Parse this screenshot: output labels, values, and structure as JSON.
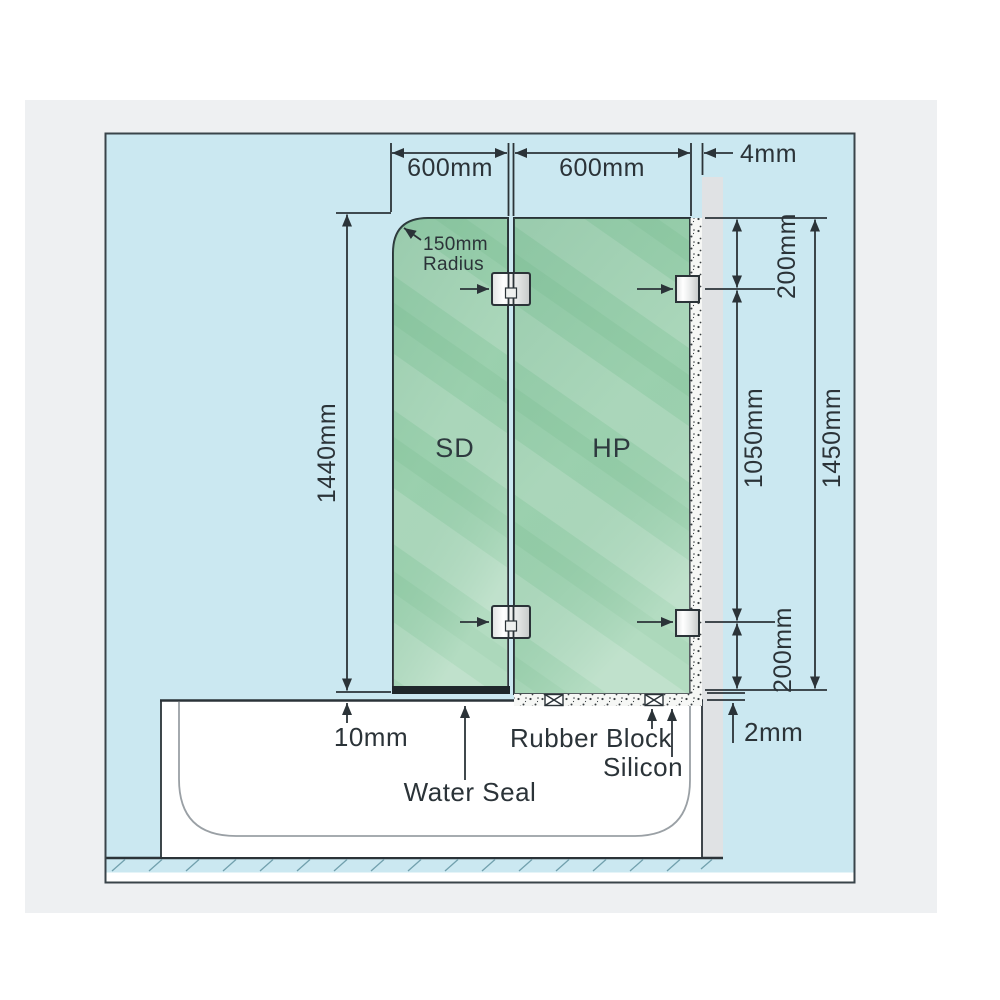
{
  "diagram_title": "Bath shower screen installation dimensions",
  "top_dims": {
    "sd_width": "600mm",
    "hp_width": "600mm",
    "wall_gap": "4mm"
  },
  "left_dim": {
    "panel_height": "1440mm"
  },
  "right_dims": {
    "top_bracket_offset": "200mm",
    "bracket_spacing": "1050mm",
    "bottom_bracket_offset": "200mm",
    "overall_height": "1450mm"
  },
  "panels": {
    "sd_label": "SD",
    "hp_label": "HP"
  },
  "radius_note": {
    "line1": "150mm",
    "line2": "Radius"
  },
  "bottom_labels": {
    "tub_gap": "10mm",
    "water_seal": "Water Seal",
    "rubber_block": "Rubber Block",
    "silicon": "Silicon",
    "floor_gap": "2mm"
  },
  "colors": {
    "background_blue": "#cbe8f1",
    "card_gray": "#eef0f2",
    "wall_gray": "#e0e2e4",
    "glass_green": "#9ed2b0",
    "glass_green_light": "#aed9bd",
    "line_dark": "#2b3338",
    "tub_white": "#ffffff",
    "tub_inner_line": "#9aa0a5",
    "hatch_teal": "#71a0ad"
  }
}
